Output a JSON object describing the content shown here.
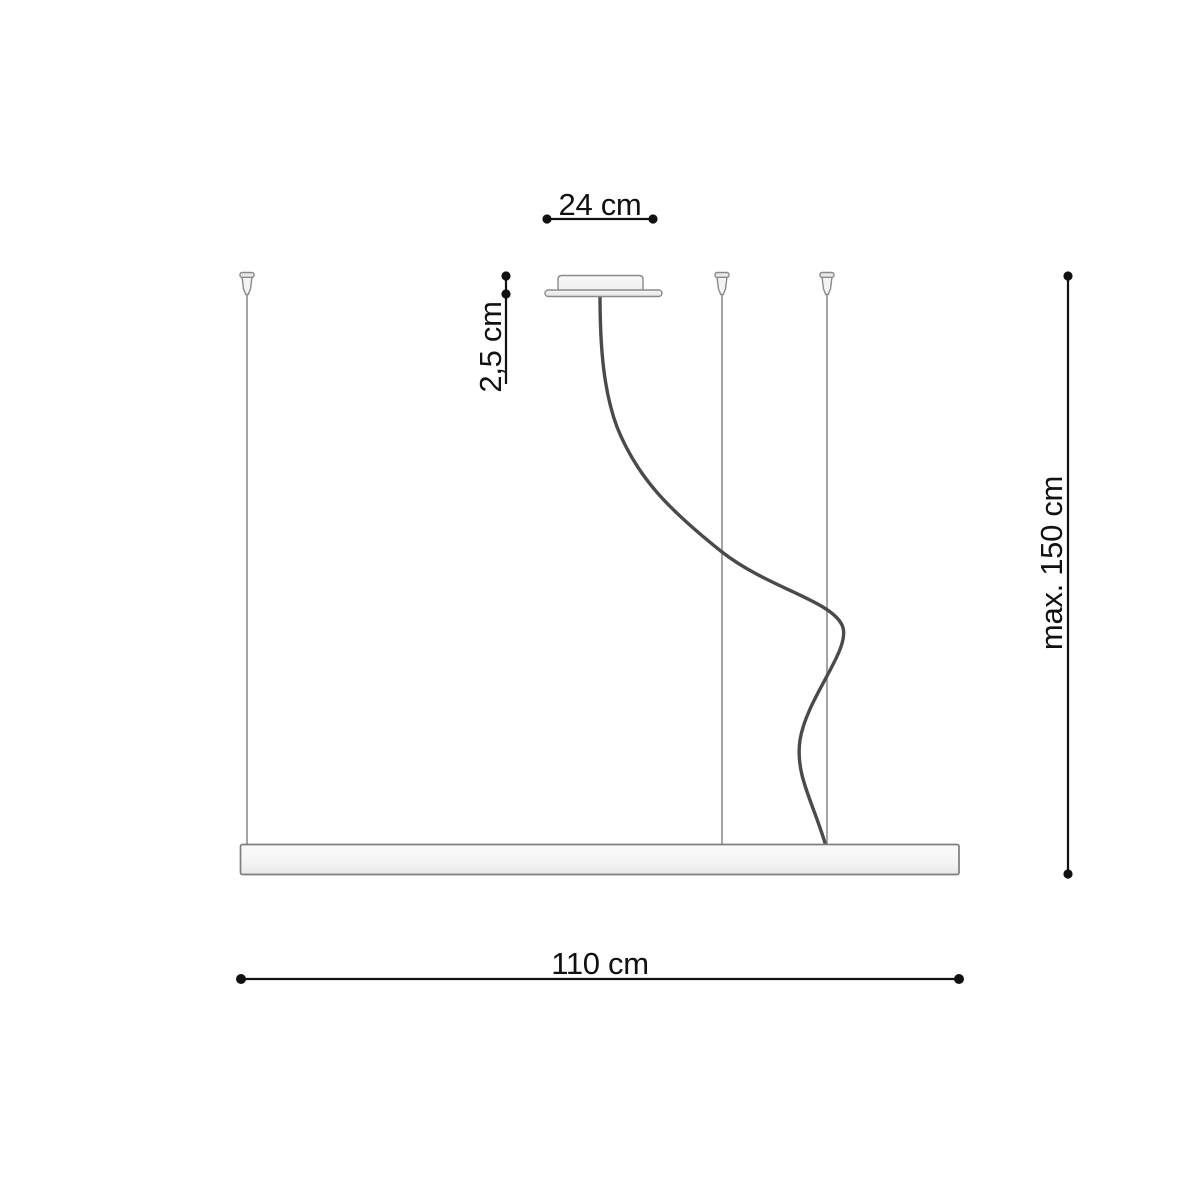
{
  "dimensions": {
    "canopy_width": {
      "label": "24 cm"
    },
    "canopy_height": {
      "label": "2,5 cm"
    },
    "max_suspension": {
      "label": "max. 150 cm"
    },
    "fixture_length": {
      "label": "110 cm"
    }
  },
  "colors": {
    "background": "#ffffff",
    "dimension": "#111111",
    "wire": "#a0a0a0",
    "cable": "#4a4a4a",
    "outline": "#8a8a8a",
    "fill_light": "#f5f5f5"
  }
}
